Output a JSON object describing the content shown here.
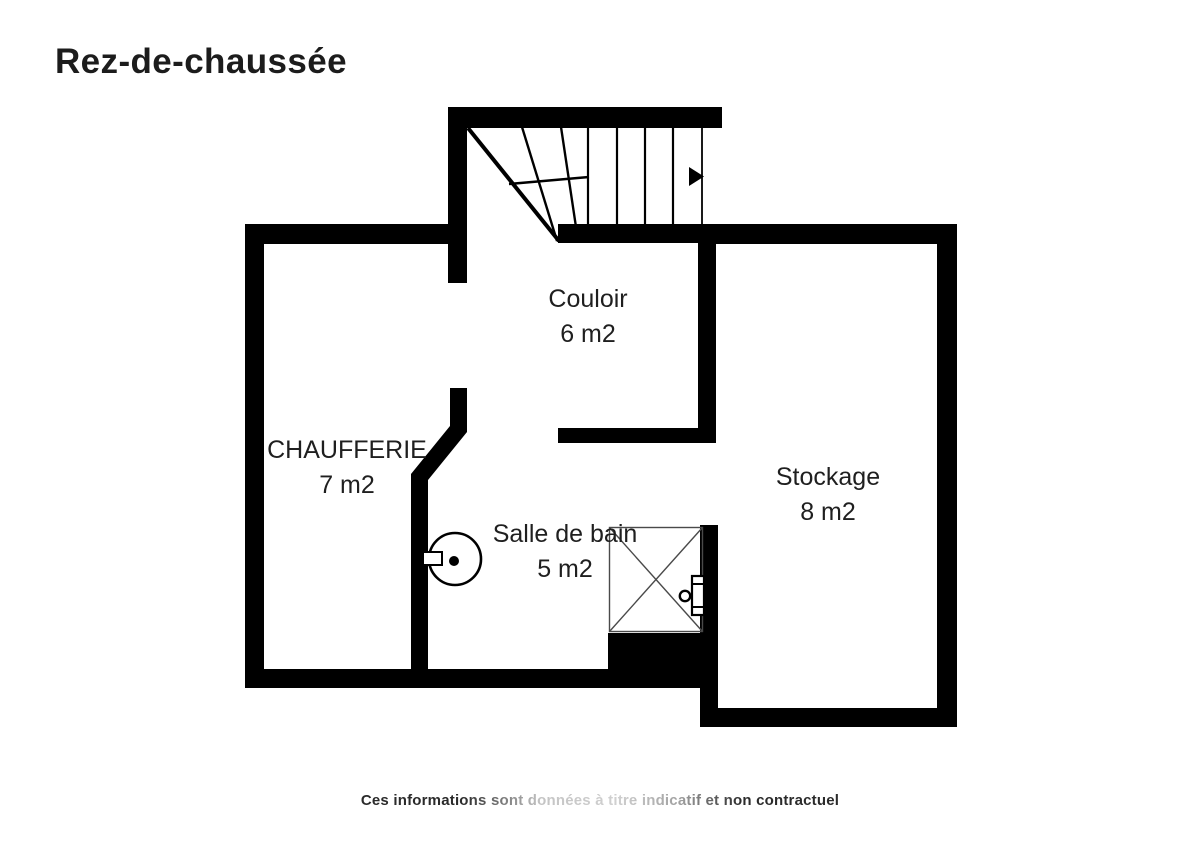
{
  "page": {
    "title": "Rez-de-chaussée",
    "disclaimer": "Ces informations sont données à titre indicatif et non contractuel"
  },
  "colors": {
    "wall": "#000000",
    "text": "#1f1f1f",
    "fixture_line": "#4a4a4a"
  },
  "rooms": [
    {
      "name": "Couloir",
      "area": "6 m2"
    },
    {
      "name": "CHAUFFERIE",
      "area": "7 m2"
    },
    {
      "name": "Salle de bain",
      "area": "5 m2"
    },
    {
      "name": "Stockage",
      "area": "8 m2"
    }
  ],
  "icons": [
    "staircase-icon",
    "stair-direction-arrow-icon",
    "water-heater-icon",
    "shower-tray-icon",
    "radiator-valve-icon"
  ]
}
